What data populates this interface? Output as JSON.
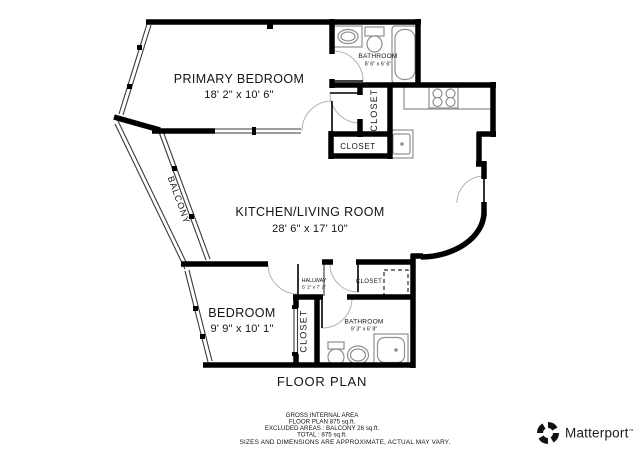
{
  "title": "FLOOR PLAN",
  "rooms": {
    "primary_bedroom": {
      "name": "PRIMARY BEDROOM",
      "dims": "18' 2\" x 10' 6\""
    },
    "bathroom_top": {
      "name": "BATHROOM",
      "dims": "8' 6\" x 6' 6\""
    },
    "closet_bathroom": {
      "label": "CLOSET"
    },
    "closet_kitchen": {
      "label": "CLOSET"
    },
    "kitchen_living": {
      "name": "KITCHEN/LIVING ROOM",
      "dims": "28' 6\" x 17' 10\""
    },
    "balcony": {
      "label": "BALCONY"
    },
    "bedroom": {
      "name": "BEDROOM",
      "dims": "9' 9\" x 10' 1\""
    },
    "hallway": {
      "name": "HALLWAY",
      "dims": "5' 2\" x 7' 2\""
    },
    "closet_hallway": {
      "label": "CLOSET"
    },
    "closet_bedroom": {
      "label": "CLOSET"
    },
    "bathroom_bottom": {
      "name": "BATHROOM",
      "dims": "9' 3\" x 6' 8\""
    }
  },
  "footer": {
    "line1": "GROSS INTERNAL AREA",
    "line2": "FLOOR PLAN 875 sq.ft.",
    "line3": "EXCLUDED AREAS :  BALCONY 26 sq.ft.",
    "line4": "TOTAL :  875 sq.ft.",
    "disclaimer": "SIZES AND DIMENSIONS ARE APPROXIMATE, ACTUAL MAY VARY."
  },
  "branding": {
    "wordmark": "Matterport",
    "trademark": "™"
  },
  "colors": {
    "wall": "#000000",
    "fixture": "#8f8f8f",
    "text": "#141414"
  }
}
